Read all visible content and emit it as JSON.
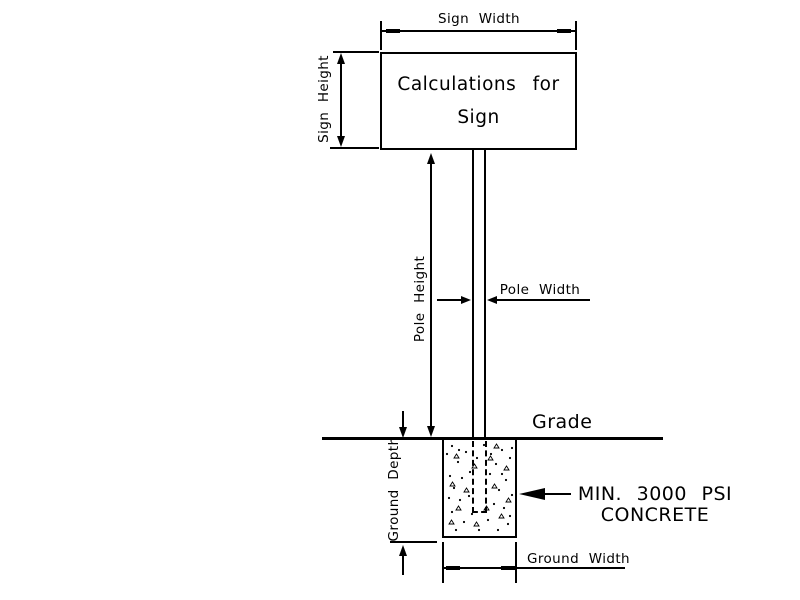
{
  "colors": {
    "line": "#000000",
    "background": "#ffffff"
  },
  "diagram": {
    "sign": {
      "width_label": "Sign Width",
      "height_label": "Sign Height",
      "box_line1": "Calculations for",
      "box_line2": "Sign"
    },
    "pole": {
      "height_label": "Pole Height",
      "width_label": "Pole Width"
    },
    "ground": {
      "grade_label": "Grade",
      "depth_label": "Ground Depth",
      "width_label": "Ground Width"
    },
    "concrete": {
      "note_line1": "MIN. 3000 PSI",
      "note_line2": "CONCRETE"
    }
  }
}
